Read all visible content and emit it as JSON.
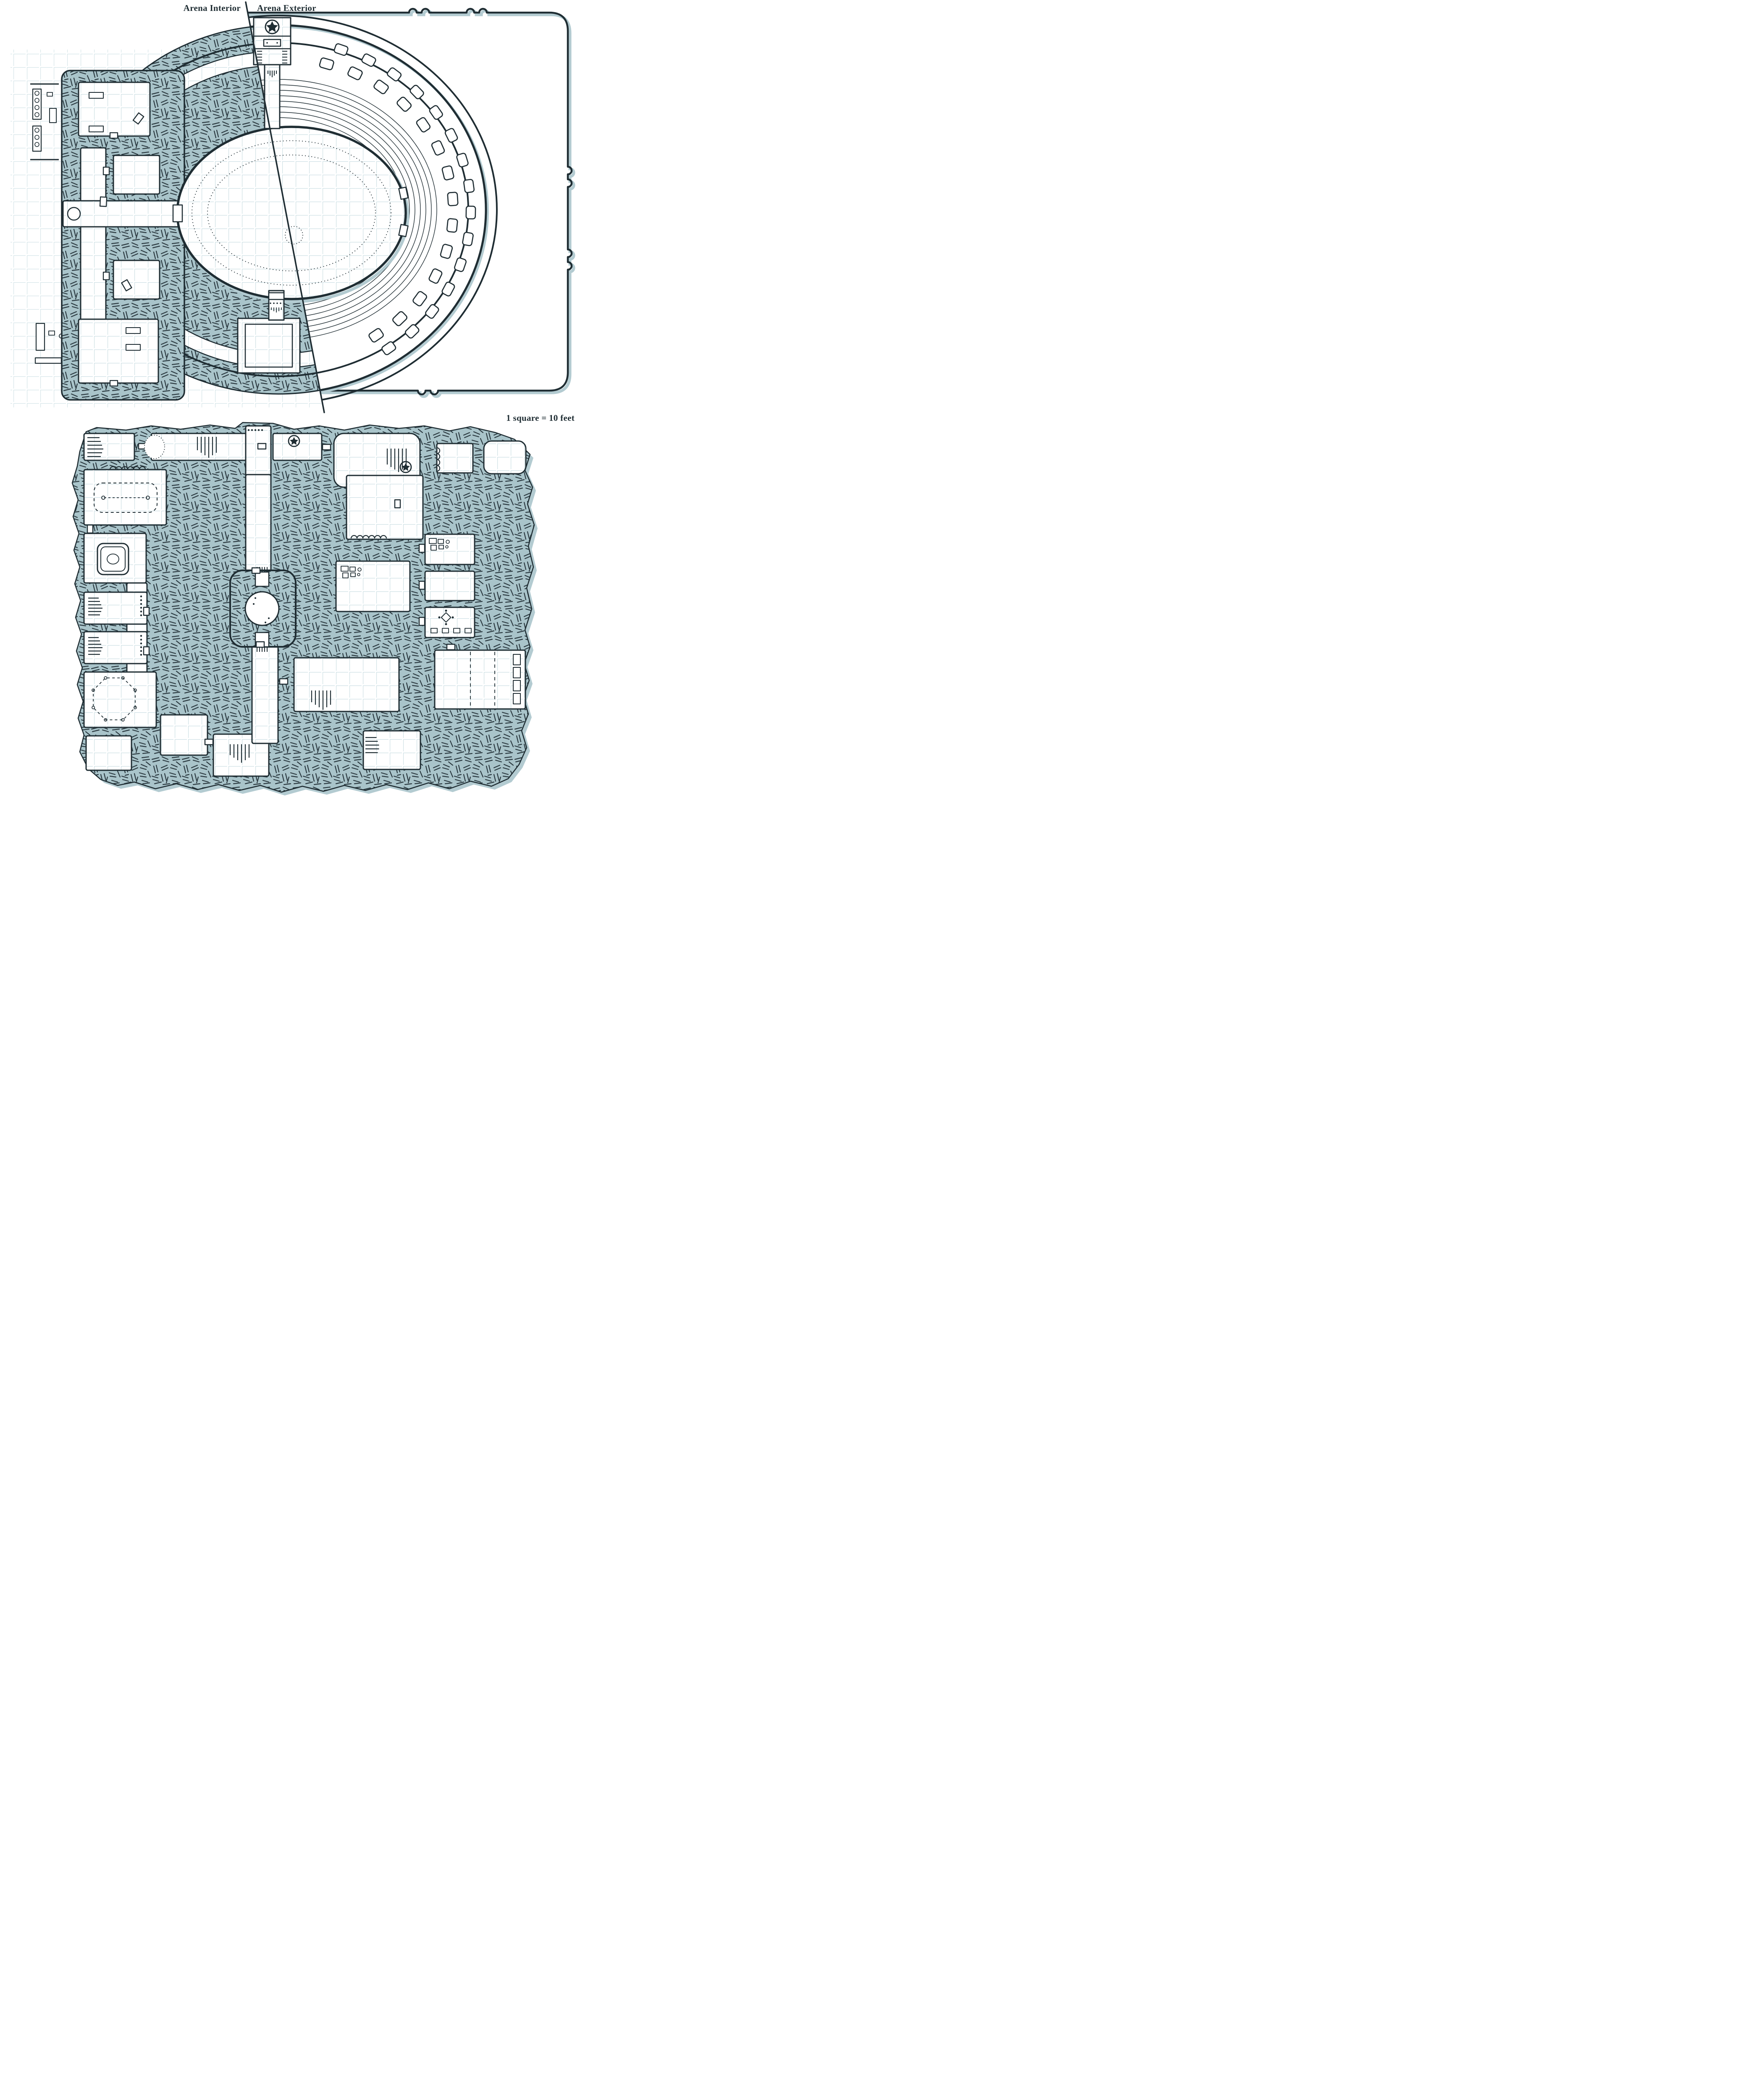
{
  "theme": {
    "ink": "#1f2d33",
    "wall_fill": "#a9c4ca",
    "shadow": "#b3cbd1",
    "grid": "#c9dde2",
    "paper": "#ffffff"
  },
  "arena_map": {
    "interior_label": "Arena Interior",
    "exterior_label": "Arena Exterior",
    "icons": [
      "star-emblem-icon",
      "seat-box-icon",
      "seating-row-icon",
      "arena-floor-oval",
      "concourse-ring",
      "walkway-ring",
      "west-annex-rooms",
      "gate-icon",
      "stairs-icon",
      "shelf-icon",
      "weapon-rack-icon",
      "divider-line"
    ]
  },
  "scale_note": "1 square = 10 feet",
  "dungeon_map": {
    "icons": [
      "well-with-ladders-icon",
      "pool-icon",
      "dashed-table-icon",
      "dashed-octagon-icon",
      "star-emblem-icon",
      "stairs-icon",
      "crates-icon",
      "bed-icon",
      "gem-icon",
      "chair-icon",
      "curtain-doorway-icon",
      "door-icon",
      "cave-mouth-icon"
    ]
  }
}
